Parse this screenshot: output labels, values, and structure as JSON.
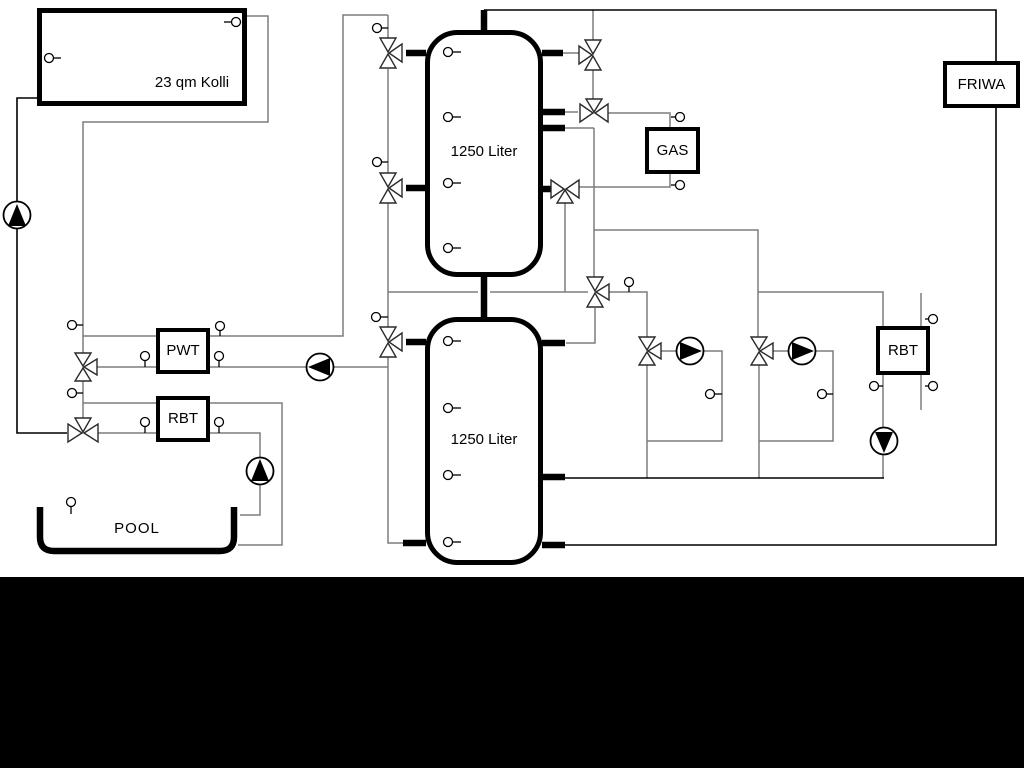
{
  "diagram_labels": {
    "collector": "23 qm Kolli",
    "tank1": "1250 Liter",
    "tank2": "1250 Liter",
    "gas": "GAS",
    "friwa": "FRIWA",
    "pwt": "PWT",
    "rbt_pool": "RBT",
    "rbt_dhw": "RBT",
    "pool": "POOL"
  },
  "colors": {
    "pipe_gray": "#7d7d7d",
    "pipe_black": "#000000",
    "symbol_stroke": "#2a2a2a",
    "background": "#ffffff",
    "bottom_band": "#000000"
  }
}
